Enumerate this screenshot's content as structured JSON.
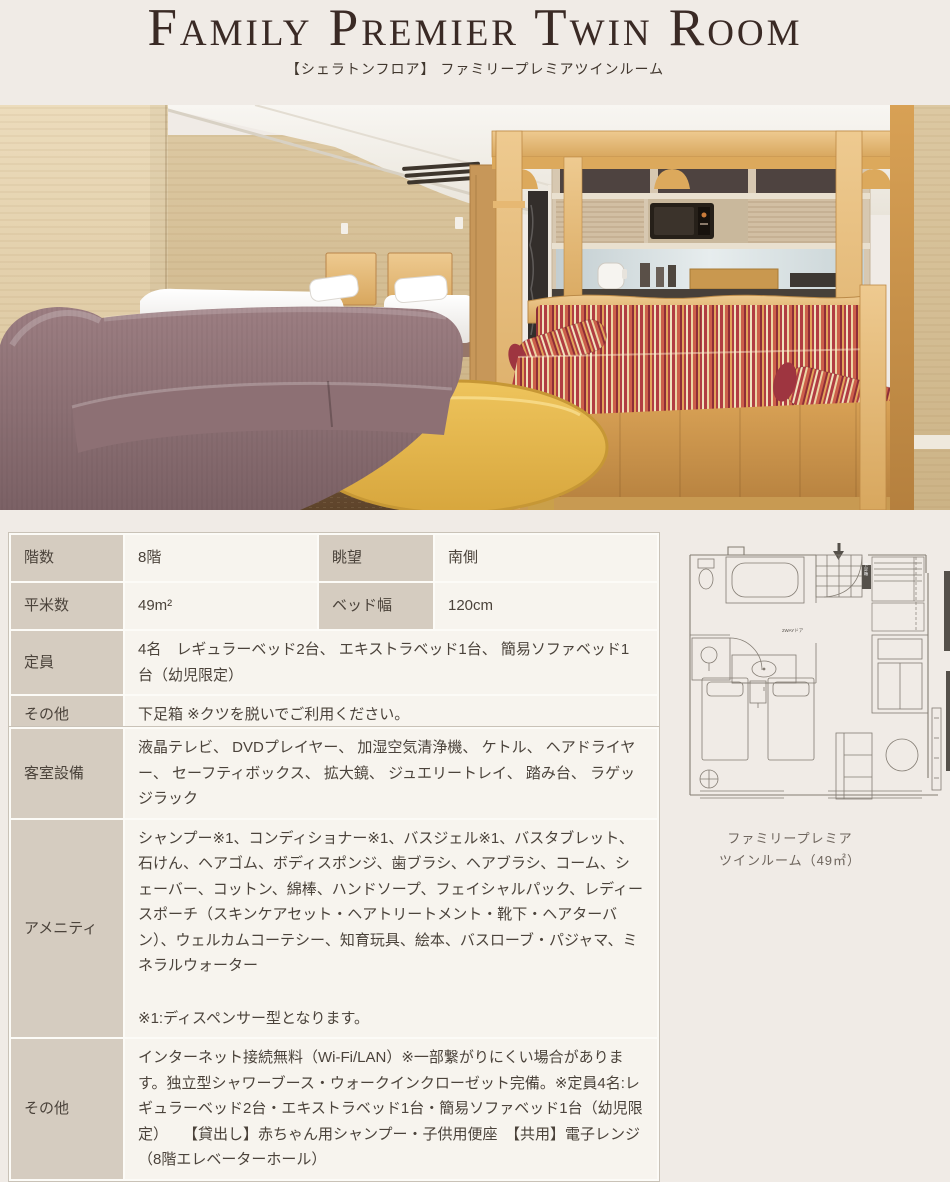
{
  "header": {
    "title": "Family Premier Twin Room",
    "subtitle": "【シェラトンフロア】 ファミリープレミアツインルーム"
  },
  "spec_table": {
    "rows_paired": [
      {
        "label1": "階数",
        "value1": "8階",
        "label2": "眺望",
        "value2": "南側"
      },
      {
        "label1": "平米数",
        "value1": "49m²",
        "label2": "ベッド幅",
        "value2": "120cm"
      }
    ],
    "rows_full": [
      {
        "label": "定員",
        "value": "4名　レギュラーベッド2台、 エキストラベッド1台、 簡易ソファベッド1台（幼児限定）"
      },
      {
        "label": "その他",
        "value": "下足箱 ※クツを脱いでご利用ください。"
      }
    ]
  },
  "facility_table": {
    "rows": [
      {
        "label": "客室設備",
        "value": "液晶テレビ、 DVDプレイヤー、 加湿空気清浄機、 ケトル、 ヘアドライヤー、 セーフティボックス、 拡大鏡、 ジュエリートレイ、 踏み台、 ラゲッジラック"
      },
      {
        "label": "アメニティ",
        "value": "シャンプー※1、コンディショナー※1、バスジェル※1、バスタブレット、石けん、ヘアゴム、ボディスポンジ、歯ブラシ、ヘアブラシ、コーム、シェーバー、コットン、綿棒、ハンドソープ、フェイシャルパック、レディースポーチ（スキンケアセット・ヘアトリートメント・靴下・ヘアターバン）、ウェルカムコーテシー、知育玩具、絵本、バスローブ・パジャマ、ミネラルウォーター",
        "note": "※1:ディスペンサー型となります。"
      },
      {
        "label": "その他",
        "value": "インターネット接続無料（Wi-Fi/LAN）※一部繋がりにくい場合があります。独立型シャワーブース・ウォークインクローゼット完備。※定員4名:レギュラーベッド2台・エキストラベッド1台・簡易ソファベッド1台（幼児限定）　　【貸出し】赤ちゃん用シャンプー・子供用便座　【共用】電子レンジ（8階エレベーターホール）"
      }
    ]
  },
  "floorplan": {
    "caption_line1": "ファミリープレミア",
    "caption_line2": "ツインルーム（49㎡）",
    "labels": {
      "shoebox": "下足箱",
      "door": "2WAYドア"
    }
  },
  "colors": {
    "page_bg": "#f0ebe6",
    "title_text": "#3a2a25",
    "table_header_bg": "#d5ccc0",
    "table_cell_bg": "#f7f4ee",
    "table_border": "#c9c2b7"
  }
}
